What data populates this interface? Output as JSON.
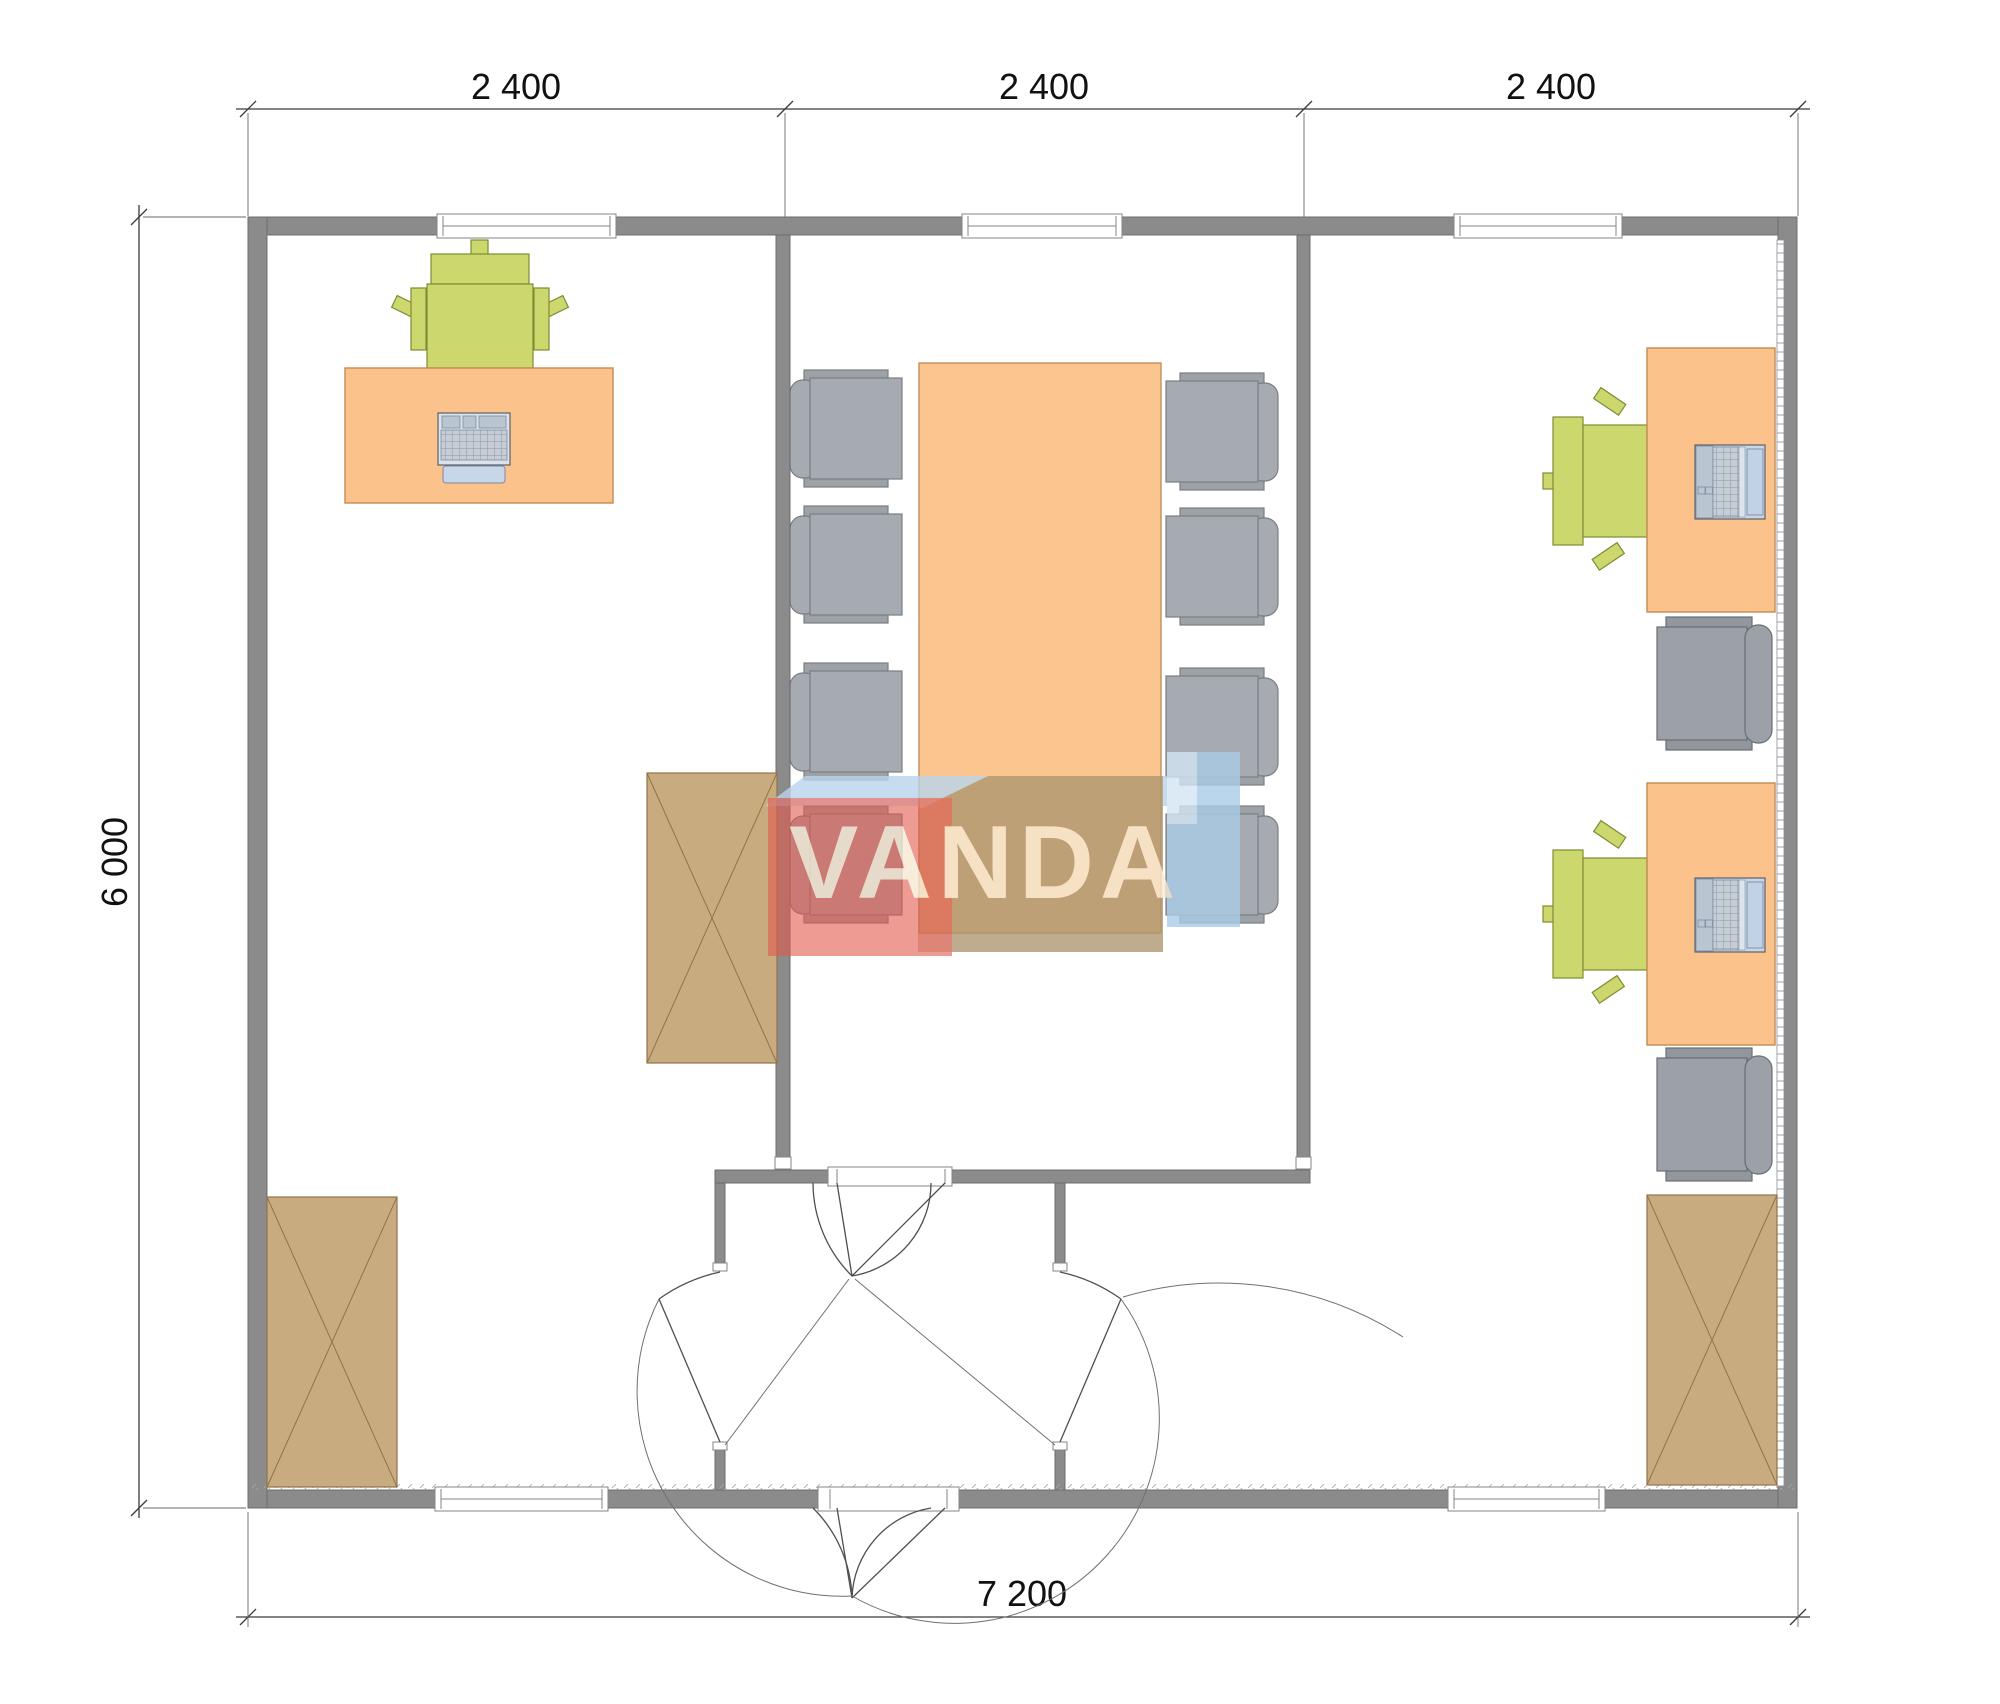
{
  "plan": {
    "title_visible_text_none": "",
    "dimension_labels": {
      "top": [
        "2 400",
        "2 400",
        "2 400"
      ],
      "left": "6 000",
      "bottom": "7 200"
    },
    "logo_text": "VANDA",
    "colors": {
      "wall_gray": "#8b8b8b",
      "desk_orange": "#fbc38b",
      "table_orange": "#fbc38b",
      "chair_gray": "#9ba1a7",
      "chair_green": "#ccd76d",
      "cabinet_tan": "#c9ab80",
      "logo_red": "#e2574c",
      "logo_blue_band": "#b9d5ec",
      "logo_blue_block": "#a9cce8",
      "logo_tan_box": "#b09671",
      "logo_letters": "#f7e8d3",
      "dimension_ink": "#111111"
    },
    "rooms": [
      {
        "name": "office-left",
        "furniture": [
          "desk-with-keyboard",
          "green-task-chair",
          "wardrobe-x-symbol",
          "cabinet-x-symbol"
        ]
      },
      {
        "name": "meeting-room",
        "furniture": [
          "conference-table",
          "conference-chair x8"
        ]
      },
      {
        "name": "office-right",
        "furniture": [
          "desk-with-laptop x2",
          "green-task-chair x2",
          "side-chair x2",
          "cabinet-x-symbol",
          "radiator-strip"
        ]
      },
      {
        "name": "entrance-vestibule",
        "furniture": [
          "exterior-double-door",
          "meeting-room-double-door",
          "door-to-left-office",
          "door-to-right-office"
        ]
      }
    ],
    "windows": {
      "top_wall": 3,
      "bottom_wall": 2
    }
  }
}
